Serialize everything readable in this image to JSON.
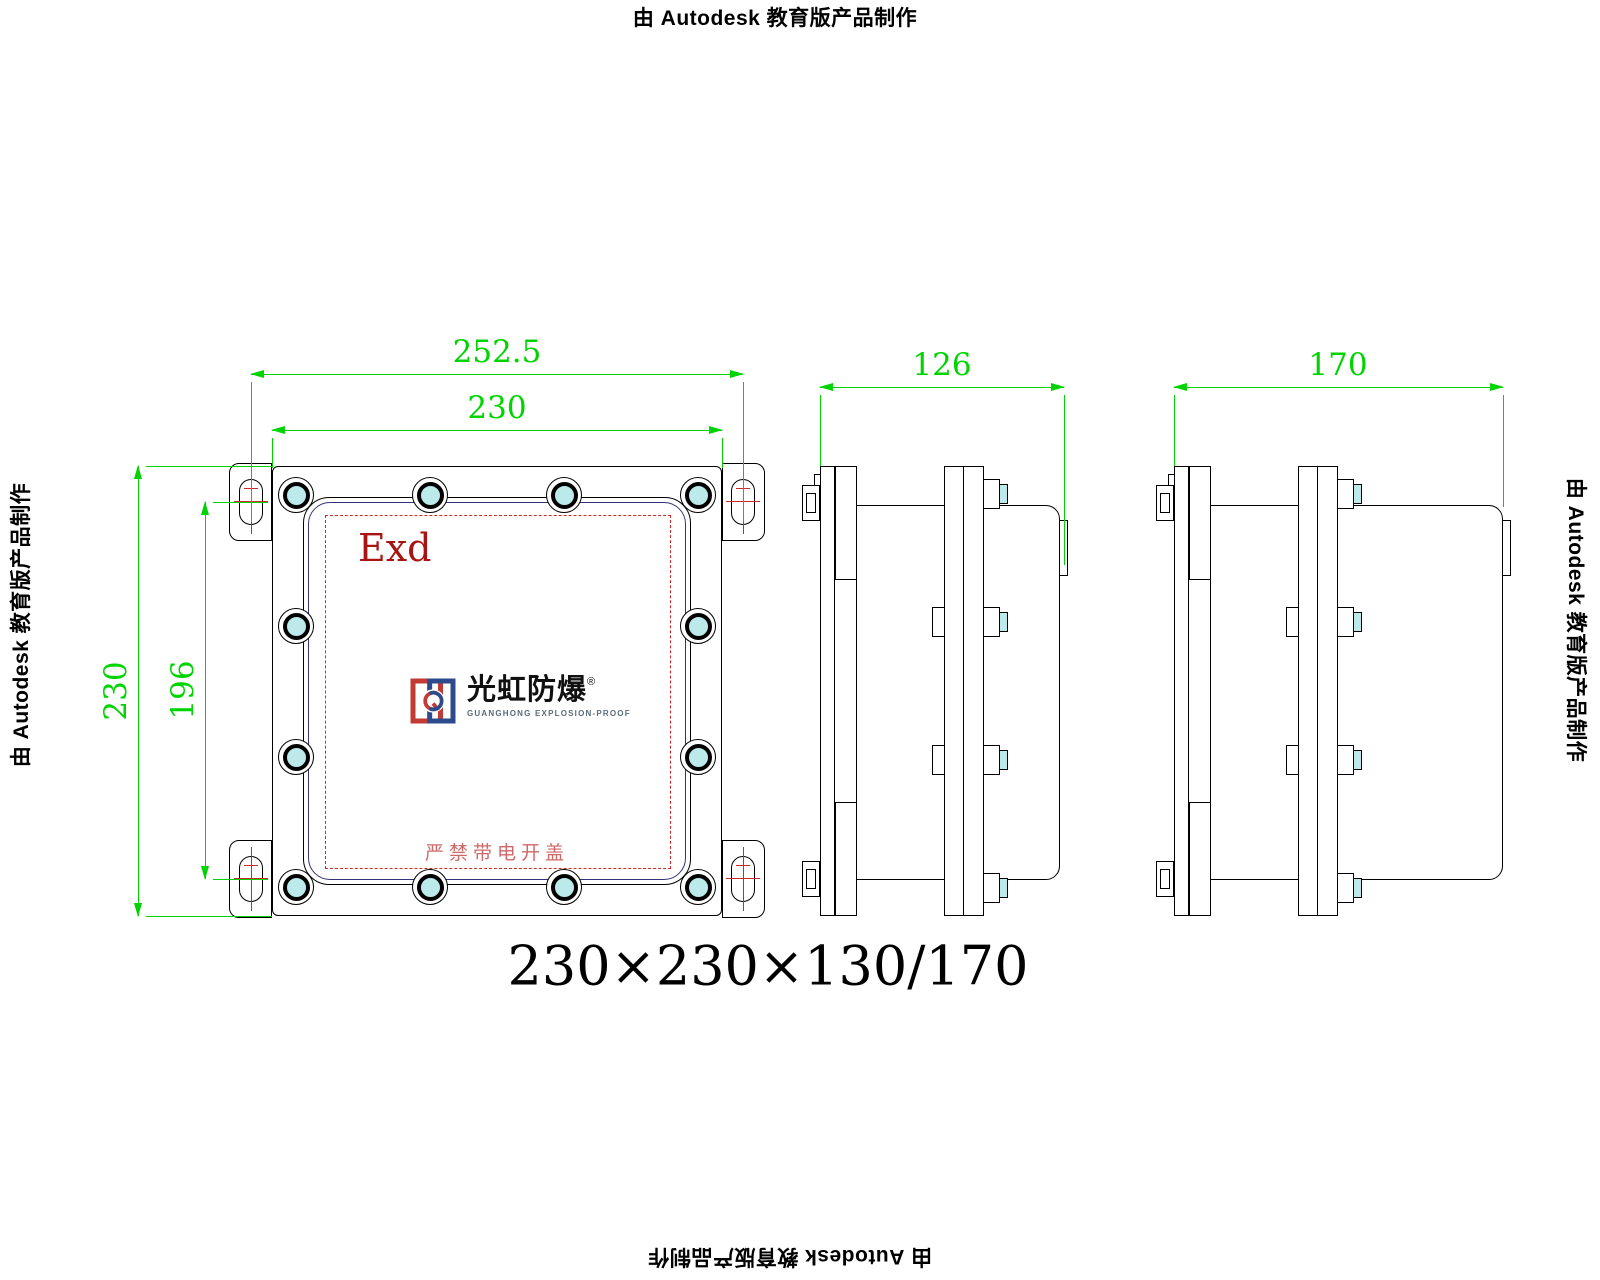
{
  "document": {
    "title": "230×230×130/170"
  },
  "notices": {
    "text": "由 Autodesk 教育版产品制作"
  },
  "front_view": {
    "marking": "Exd",
    "warning": "严禁带电开盖",
    "logo": {
      "name": "光虹防爆",
      "registered": "®",
      "subtitle": "GUANGHONG EXPLOSION-PROOF"
    }
  },
  "dimensions": {
    "mounting_width": "252.5",
    "flange_width": "230",
    "flange_height": "230",
    "mounting_height": "196",
    "depth_small": "126",
    "depth_large": "170"
  },
  "colors": {
    "dim-green": "#00d400",
    "anno-red": "#cc2a2a",
    "exd-red": "#a81414",
    "warn-red": "#cc6a6a",
    "bolt-cyan": "#bce9e9",
    "lid-navy": "#333377",
    "logo-red": "#c23a34",
    "logo-blue": "#2c4a8c",
    "logo-sub": "#5a6b7a"
  }
}
